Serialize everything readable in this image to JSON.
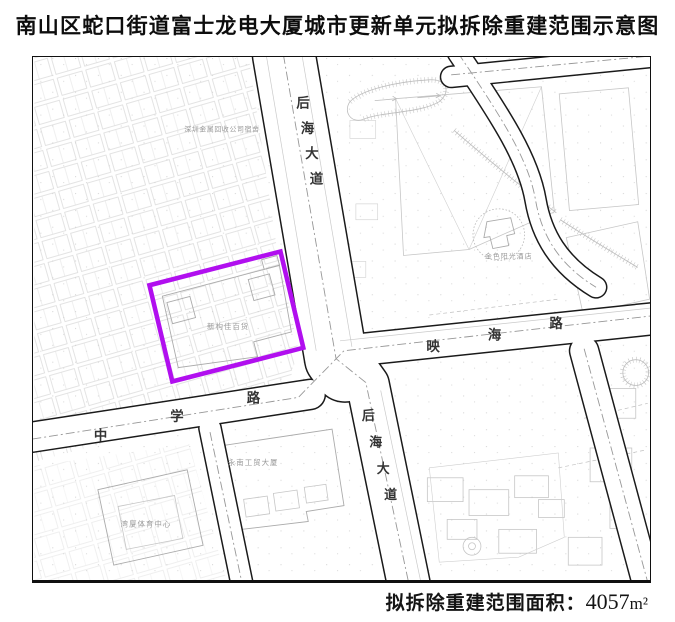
{
  "title": "南山区蛇口街道富士龙电大厦城市更新单元拟拆除重建范围示意图",
  "footer": {
    "area_label": "拟拆除重建范围面积：",
    "area_value": "4057",
    "area_unit": "m²"
  },
  "colors": {
    "scope_outline": "#b10fef",
    "road_casing": "#1a1a1a",
    "road_fill": "#ffffff",
    "centerline": "#979797",
    "parcel_line": "#c6c6c6",
    "label_gray": "#9a9a9a",
    "road_label": "#333333",
    "title_text": "#0d0d0d"
  },
  "scope_outline": {
    "points": "148,286 280,252 303,349 171,383",
    "area_sqm": "4057"
  },
  "map_labels": [
    {
      "name": "road-label-houhai-north",
      "text": "后海大道",
      "x": 296,
      "y": 107,
      "dx": 4.5,
      "dy": 25.5,
      "size": 13.5,
      "color": "#333333",
      "weight": 600
    },
    {
      "name": "road-label-houhai-south",
      "text": "后海大道",
      "x": 362,
      "y": 422,
      "dx": 7.5,
      "dy": 26.5,
      "size": 13,
      "color": "#333333",
      "weight": 600
    },
    {
      "name": "road-label-yinghai",
      "text": "映海路",
      "x": 427,
      "y": 352,
      "dx": 62,
      "dy": -11.5,
      "size": 13.5,
      "color": "#333333",
      "weight": 600
    },
    {
      "name": "road-label-zhongxue",
      "text": "中学路",
      "x": 92,
      "y": 442,
      "dx": 77,
      "dy": -19,
      "size": 13.5,
      "color": "#333333",
      "weight": 600
    },
    {
      "name": "building-label-scope-store",
      "text": "新构佳百货",
      "x": 206,
      "y": 330,
      "dx": 8.5,
      "dy": 0,
      "size": 7.5,
      "color": "#9a9a9a",
      "weight": 400
    },
    {
      "name": "building-label-metal-recycling",
      "text": "深圳金属回收公司宿舍",
      "x": 183,
      "y": 131,
      "dx": 7.6,
      "dy": 0,
      "size": 7,
      "color": "#9a9a9a",
      "weight": 400
    },
    {
      "name": "building-label-yongnan-trade",
      "text": "永南工贸大厦",
      "x": 227,
      "y": 467,
      "dx": 8.5,
      "dy": 0,
      "size": 7.5,
      "color": "#9a9a9a",
      "weight": 400
    },
    {
      "name": "building-label-wanxia-sports",
      "text": "湾厦体育中心",
      "x": 119,
      "y": 529,
      "dx": 8.5,
      "dy": 0,
      "size": 7.5,
      "color": "#9a9a9a",
      "weight": 400
    },
    {
      "name": "building-label-golden-sun-hotel",
      "text": "金色阳光酒店",
      "x": 486,
      "y": 259,
      "dx": 8,
      "dy": 0,
      "size": 7,
      "color": "#9a9a9a",
      "weight": 400
    }
  ]
}
